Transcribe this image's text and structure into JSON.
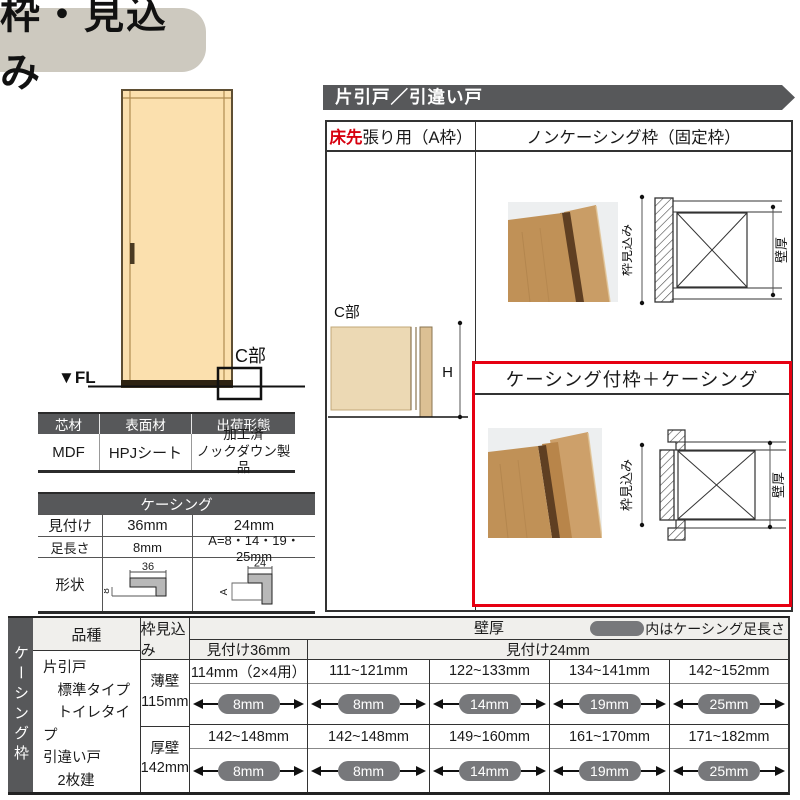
{
  "title": "枠・見込み",
  "banner": "片引戸／引違い戸",
  "door_figure": {
    "fl_label": "▼FL",
    "c_label": "C部"
  },
  "material_table": {
    "headers": [
      "芯材",
      "表面材",
      "出荷形態"
    ],
    "values": [
      "MDF",
      "HPJシート",
      "加工済\nノックダウン製品"
    ]
  },
  "casing_table": {
    "title": "ケーシング",
    "row_mitsuke": {
      "label": "見付け",
      "v36": "36mm",
      "v24": "24mm"
    },
    "row_ashinagasa": {
      "label": "足長さ",
      "v36": "8mm",
      "v24": "A=8・14・19・25mm"
    },
    "row_keijo": {
      "label": "形状"
    },
    "shape36": {
      "top": "36",
      "side": "8"
    },
    "shape24": {
      "top": "24",
      "side": "A"
    }
  },
  "frame_panel": {
    "col_a_red": "床先",
    "col_a_rest": "張り用（A枠）",
    "col_b_header": "ノンケーシング枠（固定枠）",
    "c_detail": {
      "label": "C部",
      "h": "H"
    },
    "noncasing": {
      "dim_left": "枠見込み",
      "dim_right": "壁厚"
    },
    "casing": {
      "title": "ケーシング付枠＋ケーシング",
      "dim_left": "枠見込み",
      "dim_right": "壁厚"
    }
  },
  "bottom_table": {
    "side_label": "ケーシング枠",
    "h_hinshu": "品種",
    "h_waku": "枠見込み",
    "h_kabe": "壁厚",
    "legend": "内はケーシング足長さ",
    "h_m36": "見付け36mm",
    "h_m24": "見付け24mm",
    "hinshu": "片引戸\n　標準タイプ\n　トイレタイプ\n引違い戸\n　2枚建",
    "rows": [
      {
        "wall": "薄壁\n115mm",
        "cells": [
          {
            "value": "114mm（2×4用）",
            "pill": "8mm"
          },
          {
            "value": "111~121mm",
            "pill": "8mm"
          },
          {
            "value": "122~133mm",
            "pill": "14mm"
          },
          {
            "value": "134~141mm",
            "pill": "19mm"
          },
          {
            "value": "142~152mm",
            "pill": "25mm"
          }
        ]
      },
      {
        "wall": "厚壁\n142mm",
        "cells": [
          {
            "value": "142~148mm",
            "pill": "8mm"
          },
          {
            "value": "142~148mm",
            "pill": "8mm"
          },
          {
            "value": "149~160mm",
            "pill": "14mm"
          },
          {
            "value": "161~170mm",
            "pill": "19mm"
          },
          {
            "value": "171~182mm",
            "pill": "25mm"
          }
        ]
      }
    ]
  },
  "colors": {
    "accent_red": "#e60012",
    "header_gray": "#57585a",
    "pill_gray": "#77787b",
    "title_bg": "#cdc9bf",
    "door_cream": "#fbe0ae"
  }
}
